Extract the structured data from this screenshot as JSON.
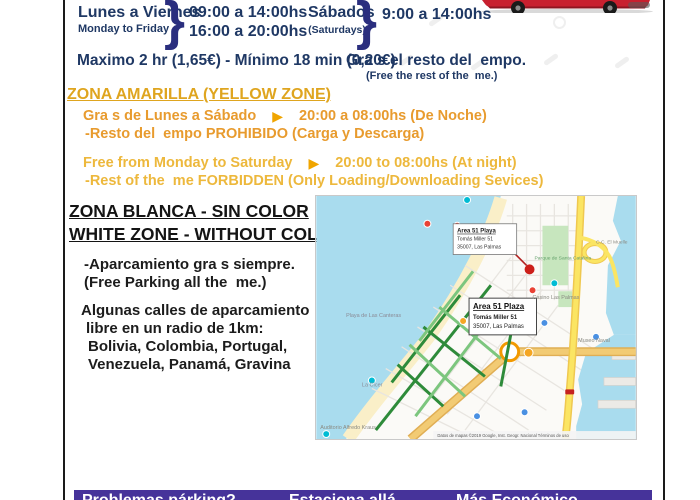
{
  "page": {
    "background": "#FFFFFF",
    "frame_color": "#1A1A1A"
  },
  "icons": {
    "arrow_right": "▶",
    "brace": "}"
  },
  "header": {
    "weekdays_label": "Lunes a Viernes",
    "weekdays_sublabel": "Monday to Friday",
    "weekdays_time1": "09:00 a 14:00hs",
    "weekdays_time2": "16:00 a 20:00hs",
    "saturdays_label": "Sábados",
    "saturdays_sublabel": "(Saturdays)",
    "saturdays_time": "9:00 a 14:00hs"
  },
  "pricing": {
    "rate_line": "Maximo 2 hr (1,65€) - Mínimo 18 min (0,20€)",
    "free_rest_es": "Gra s el resto del  empo.",
    "free_rest_en": "(Free the rest of the  me.)"
  },
  "yellow_zone": {
    "title": "ZONA AMARILLA (YELLOW ZONE)",
    "es_free": "Gra s de Lunes a Sábado",
    "es_hours": "20:00 a 08:00hs (De Noche)",
    "es_rest": "-Resto del  empo PROHIBIDO (Carga y Descarga)",
    "en_free": "Free from Monday to Saturday",
    "en_hours": "20:00 to 08:00hs (At night)",
    "en_rest": "-Rest of the  me FORBIDDEN (Only Loading/Downloading Sevices)"
  },
  "white_zone": {
    "title_es": "ZONA BLANCA - SIN COLOR",
    "title_en": "WHITE ZONE - WITHOUT COLOUR",
    "free_es": "-Aparcamiento gra s siempre.",
    "free_en": "(Free Parking all the  me.)",
    "streets": [
      "Algunas calles de aparcamiento",
      "libre en un radio de 1km:",
      "Bolivia, Colombia, Portugal,",
      "Venezuela, Panamá, Gravina"
    ]
  },
  "map": {
    "marker_playa_title": "Area 51 Playa",
    "marker_playa_street": "Tomás Miller 51",
    "marker_playa_city": "35007, Las Palmas",
    "marker_plaza_title": "Area 51 Plaza",
    "marker_plaza_street": "Tomás Miller 51",
    "marker_plaza_city": "35007, Las Palmas",
    "label_beach": "Playa de Las Canteras",
    "label_cicer": "La Cícer",
    "label_auditorium": "Auditorio Alfredo Kraus",
    "label_park": "Parque de Santa Catalina",
    "label_casino": "Casino Las Palmas",
    "label_mall": "C.C. El Muelle",
    "label_naval": "Museo Naval",
    "attribution": "Datos de mapas ©2019 Google, Inst. Geogr. Nacional    Términos de uso"
  },
  "footer": {
    "left": "Problemas párking?",
    "center": "Estaciona allá",
    "right": "Más Económico"
  },
  "colors": {
    "navy": "#1F3864",
    "gold": "#DFA51F",
    "orange": "#E89B2E",
    "yellow": "#EDB83C",
    "purple": "#46339A",
    "sea": "#A9DCEE"
  }
}
